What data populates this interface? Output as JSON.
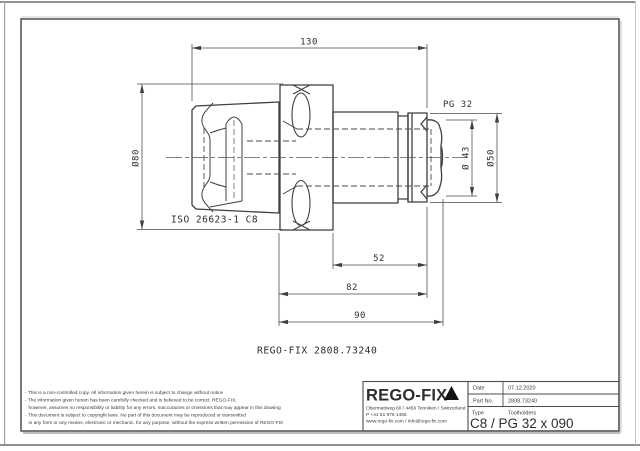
{
  "drawing": {
    "dim_130": "130",
    "dim_pg": "PG 32",
    "dim_d80": "Ø80",
    "dim_d43": "Ø 43",
    "dim_d50": "Ø50",
    "dim_52": "52",
    "dim_82": "82",
    "dim_90": "90",
    "interface_label": "ISO 26623-1 C8",
    "part_label": "REGO-FIX 2808.73240"
  },
  "notes": {
    "lines": [
      "- This is a non-controlled copy. All information given herein is subject to change without notice",
      "- The information given herein has been carefully checked and is believed to be correct. REGO-FIX,",
      "however, assumes no responsibility or liability for any errors, inaccuracies or omissions that may appear in this drawing",
      "- This document is subject to copyright laws. No part of this document may be reproduced or transmitted",
      "in any form or any means, electronic or mechanic, for any purpose, without the express written permission of REGO-FIX"
    ]
  },
  "title_block": {
    "logo_text": "REGO-FIX",
    "address_line1": "Obermattweg 60 / 4456 Tenniken / Switzerland",
    "address_line2": "P +41 61 976 1466",
    "address_line3": "www.rego-fix.com / info@rego-fix.com",
    "date_label": "Date",
    "date_value": "07.12.2020",
    "part_no_label": "Part No.",
    "part_no_value": "2808.73240",
    "type_label": "Type",
    "type_value": "Toolholders",
    "designation": "C8 / PG 32 x 090"
  }
}
